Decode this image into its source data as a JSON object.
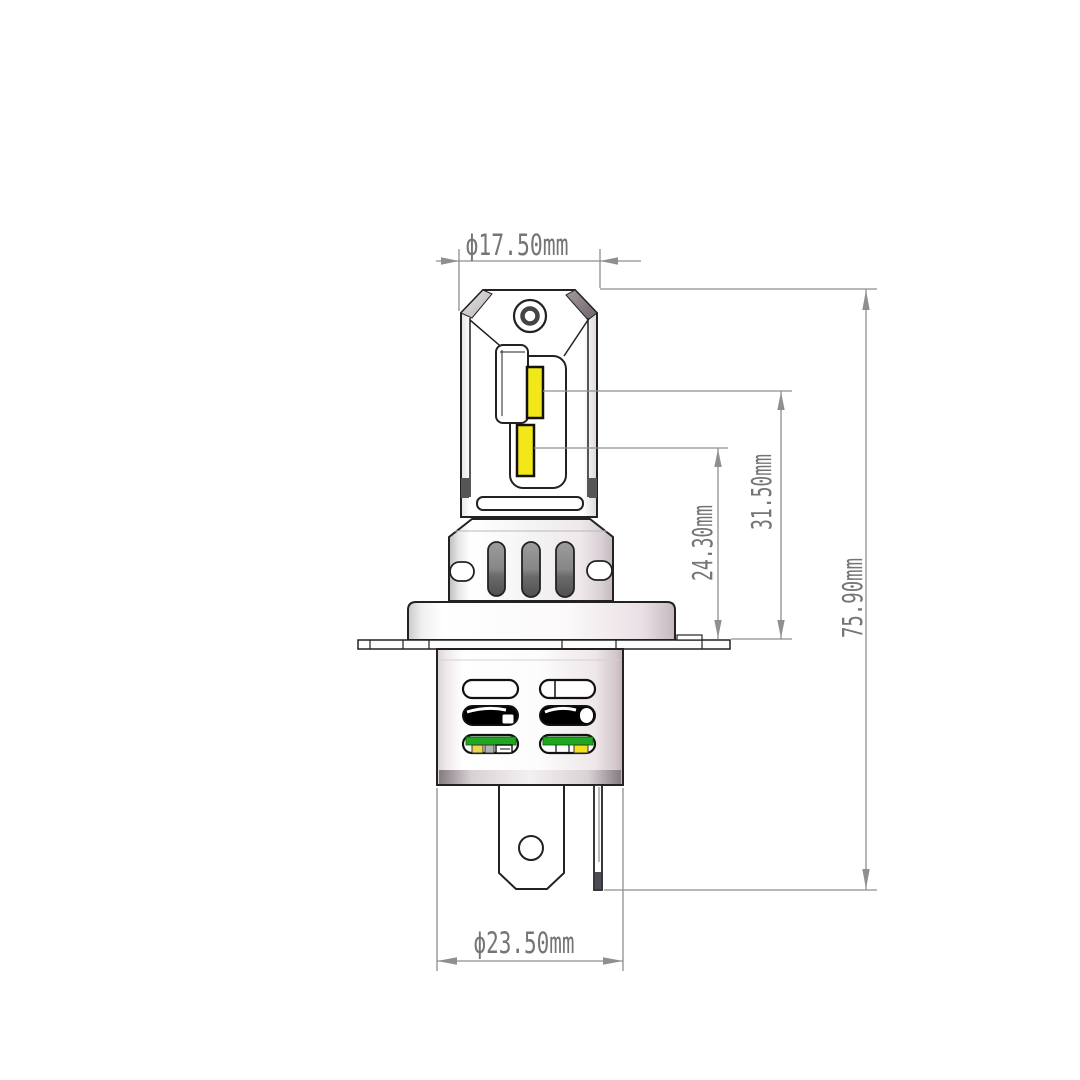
{
  "drawing": {
    "dimensions": {
      "head_diameter": "ϕ17.50mm",
      "low_led_height": "24.30mm",
      "high_led_height": "31.50mm",
      "overall_height": "75.90mm",
      "base_diameter": "ϕ23.50mm"
    },
    "colors": {
      "part_outline": "#222222",
      "dimension_line": "#8f8f8f",
      "dimension_text": "#757575",
      "led_yellow": "#f2e719",
      "pcb_green": "#1fa81f",
      "vent_black": "#000000",
      "chip_gold": "#ecd54f",
      "metal_shade": "#c4b8be",
      "background": "#ffffff"
    }
  }
}
